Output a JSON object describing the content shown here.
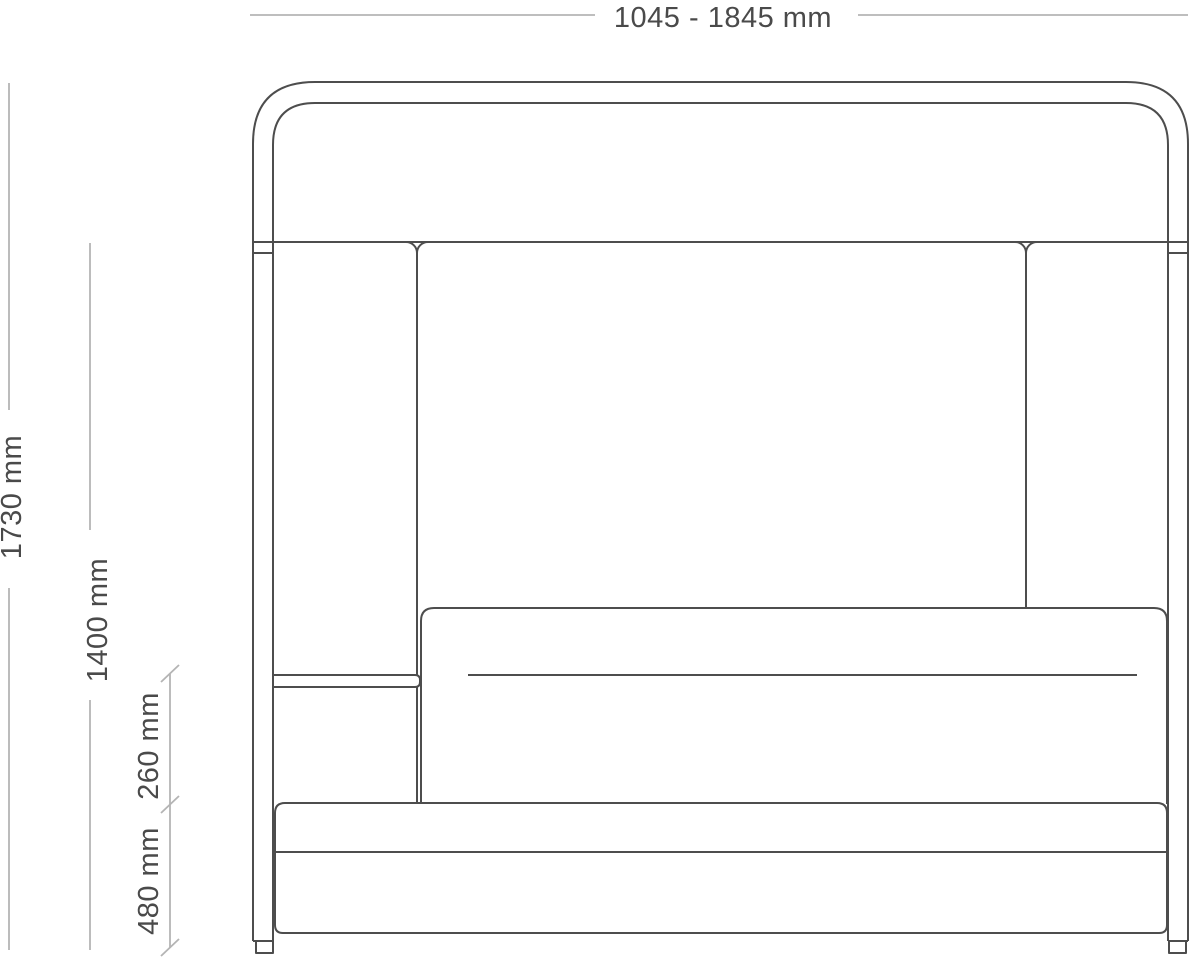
{
  "drawing": {
    "object": "canopy-sofa-front-elevation",
    "dimensions": {
      "width": {
        "label": "1045 - 1845 mm",
        "min_mm": 1045,
        "max_mm": 1845
      },
      "total_height": {
        "label": "1730 mm",
        "value_mm": 1730
      },
      "back_height": {
        "label": "1400 mm",
        "value_mm": 1400
      },
      "shelf_to_seat": {
        "label": "260 mm",
        "value_mm": 260
      },
      "seat_height": {
        "label": "480 mm",
        "value_mm": 480
      }
    },
    "colors": {
      "outline": "#4d4d4d",
      "dimension_line": "#b4b4b4",
      "label_text": "#4a4a4a",
      "background": "#ffffff"
    }
  }
}
